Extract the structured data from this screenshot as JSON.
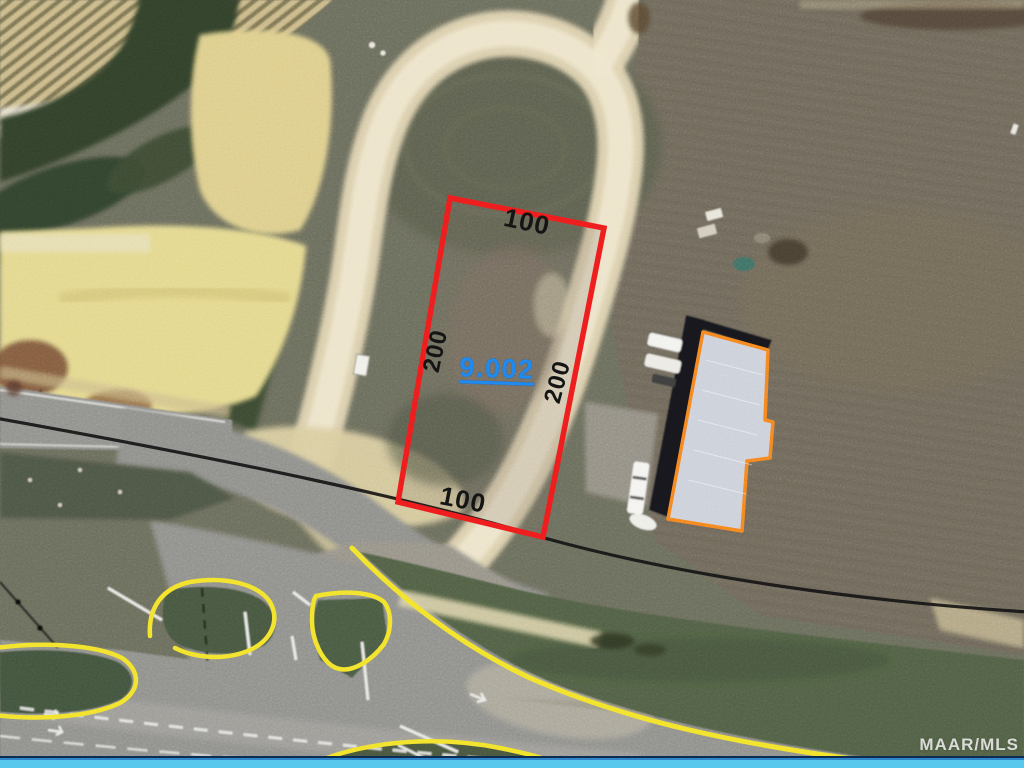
{
  "parcel": {
    "id_label": "9.002",
    "dimensions": {
      "top": "100",
      "right": "200",
      "bottom": "100",
      "left": "200"
    },
    "outline_color": "#ee1c1c",
    "id_color": "#1f8af0",
    "dimension_color": "#151515"
  },
  "building": {
    "outline_color": "#f5831f",
    "roof_color": "#ccd0da"
  },
  "annotations": {
    "road_marking_color": "#f2e22b",
    "boundary_line_color": "#141414"
  },
  "watermark": {
    "text": "MAAR/MLS",
    "color": "#e9e9e7"
  },
  "window_bar": {
    "color": "#58c8ec"
  }
}
